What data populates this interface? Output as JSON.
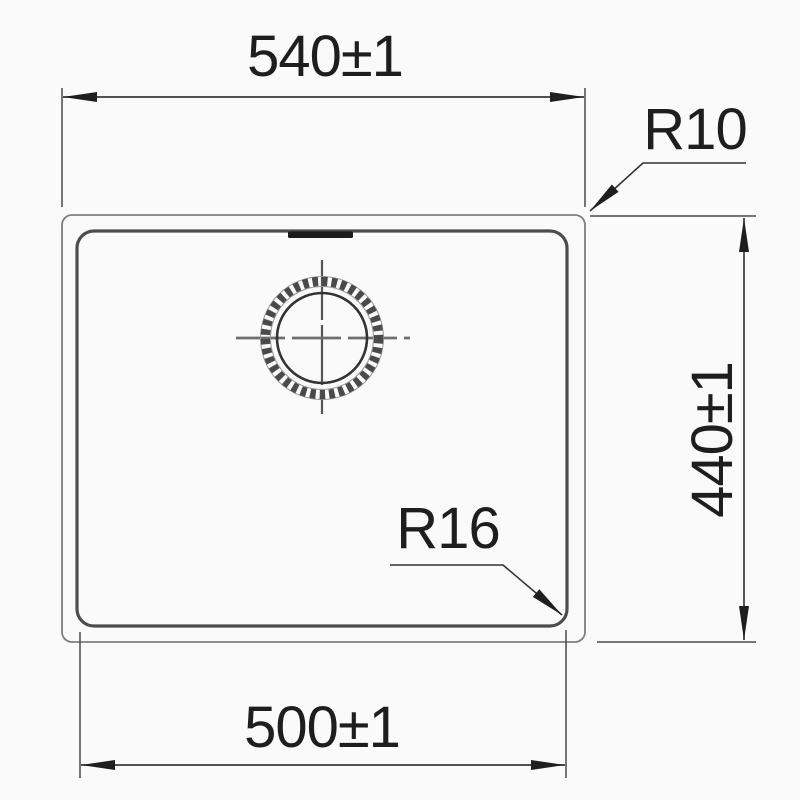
{
  "diagram": {
    "type": "technical-drawing",
    "labels": {
      "top_width": "540±1",
      "outer_corner_radius": "R10",
      "side_height": "440±1",
      "inner_corner_radius": "R16",
      "bottom_width": "500±1"
    },
    "colors": {
      "ink": "#2a2a2a",
      "outer_outline": "#7f7f7f",
      "bowl_outline": "#4d4d4d",
      "background": "#fafafa"
    }
  }
}
